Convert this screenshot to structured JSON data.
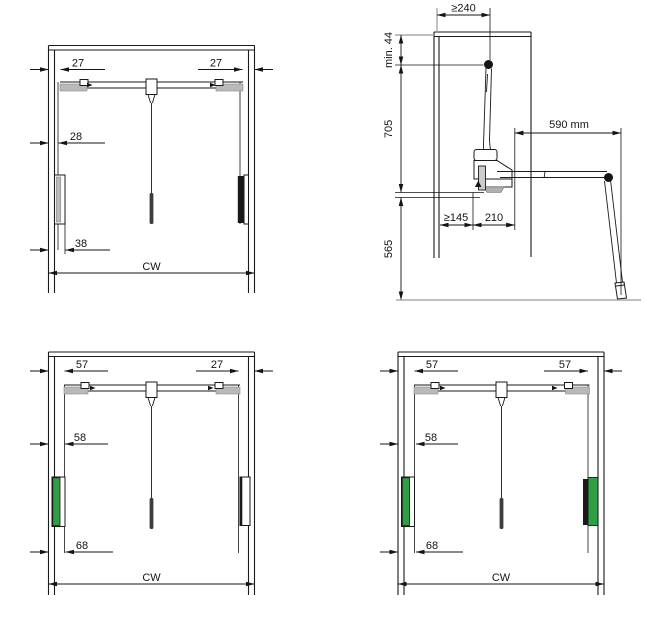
{
  "drawing": {
    "type": "wardrobe-lift-installation-dimensions",
    "colors": {
      "green": "#2f9e45",
      "gray": "#b9b9b9",
      "line": "#1a1a1a"
    },
    "panel_front_upper": {
      "dim_left_top": "27",
      "dim_right_top": "27",
      "dim_left_mid": "28",
      "dim_left_bottom": "38",
      "dim_width": "CW"
    },
    "panel_side": {
      "dim_depth_top": "≥240",
      "dim_min_top": "min. 44",
      "dim_upper_height": "705",
      "dim_arm_length": "590 mm",
      "dim_clearance": "≥145",
      "dim_base_depth": "210",
      "dim_lower_height": "565"
    },
    "panel_front_lower_left": {
      "dim_left_top": "57",
      "dim_right_top": "27",
      "dim_left_mid": "58",
      "dim_left_bottom": "68",
      "dim_width": "CW"
    },
    "panel_front_lower_right": {
      "dim_left_top": "57",
      "dim_right_top": "57",
      "dim_left_mid": "58",
      "dim_left_bottom": "68",
      "dim_width": "CW"
    }
  }
}
